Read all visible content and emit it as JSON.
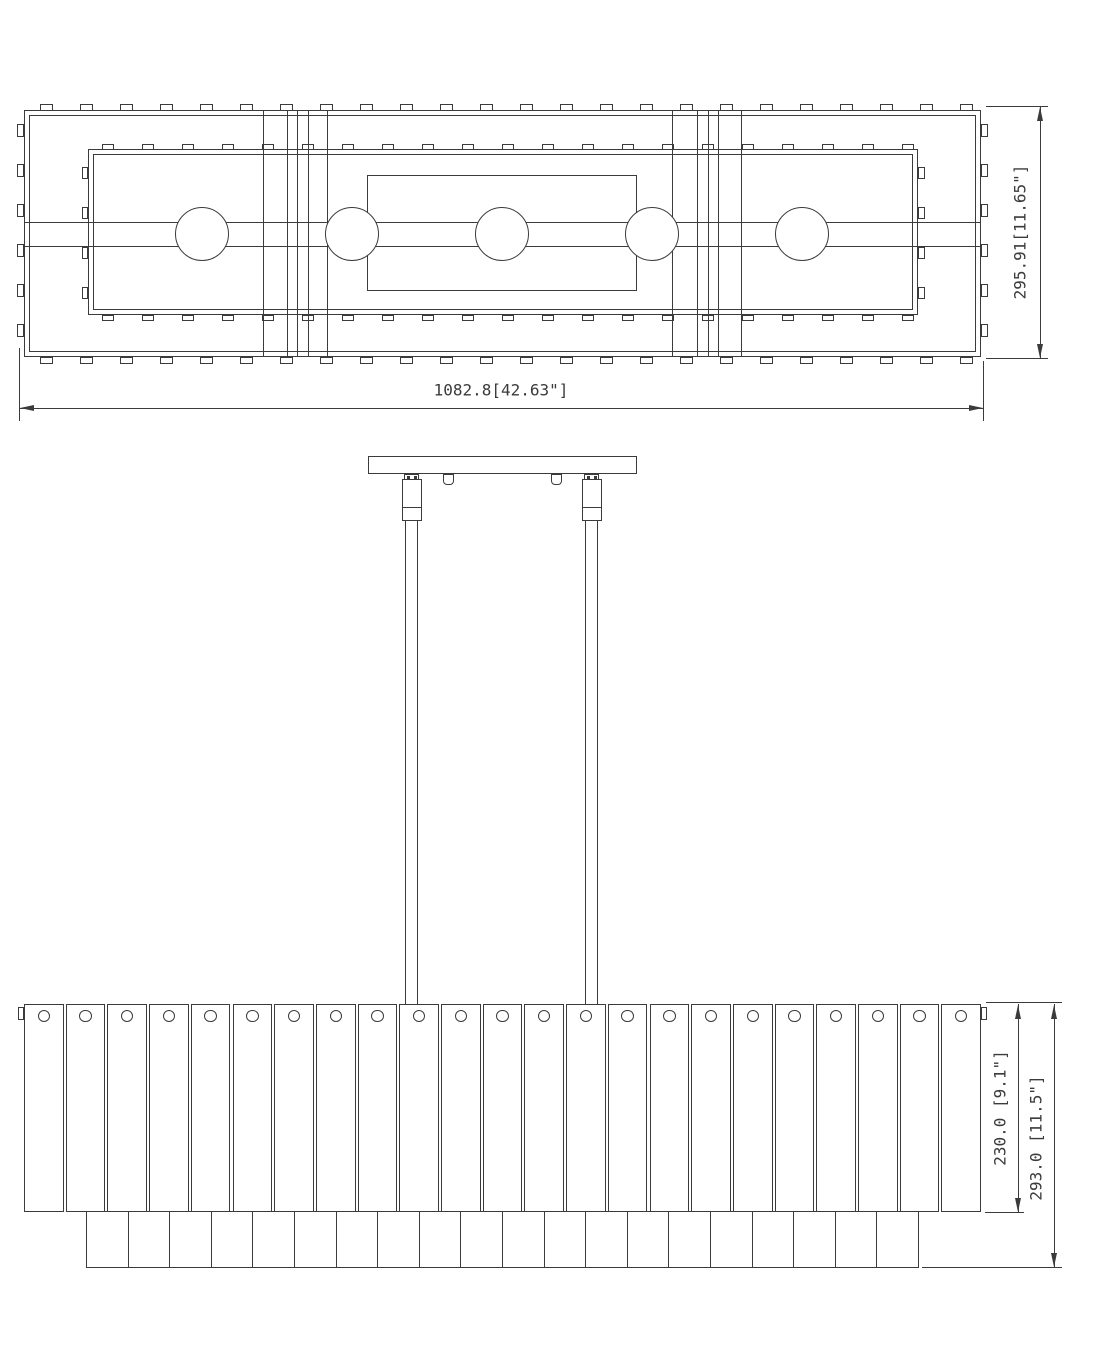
{
  "drawing_title": "linear-chandelier-dimension-drawing",
  "colors": {
    "ink": "#3b3b3b",
    "background": "#ffffff"
  },
  "top_view": {
    "name": "plan view",
    "width_label": "1082.8[42.63\"]",
    "height_label": "295.91[11.65\"]",
    "lamp_count": 5,
    "outer_tab_count_top": 24,
    "outer_tab_count_bottom": 24,
    "outer_tab_count_left": 6,
    "outer_tab_count_right": 6,
    "inner_tab_count_top": 21,
    "inner_tab_count_bottom": 21,
    "inner_tab_count_left": 4,
    "inner_tab_count_right": 4,
    "support_line_count": 10
  },
  "front_view": {
    "name": "front elevation",
    "shade_height_label": "230.0 [9.1\"]",
    "overall_height_label": "293.0 [11.5\"]",
    "slat_count": 23,
    "slat_hole_count": 23,
    "bottom_cell_count": 20,
    "rod_count": 2,
    "hook_count": 2
  }
}
